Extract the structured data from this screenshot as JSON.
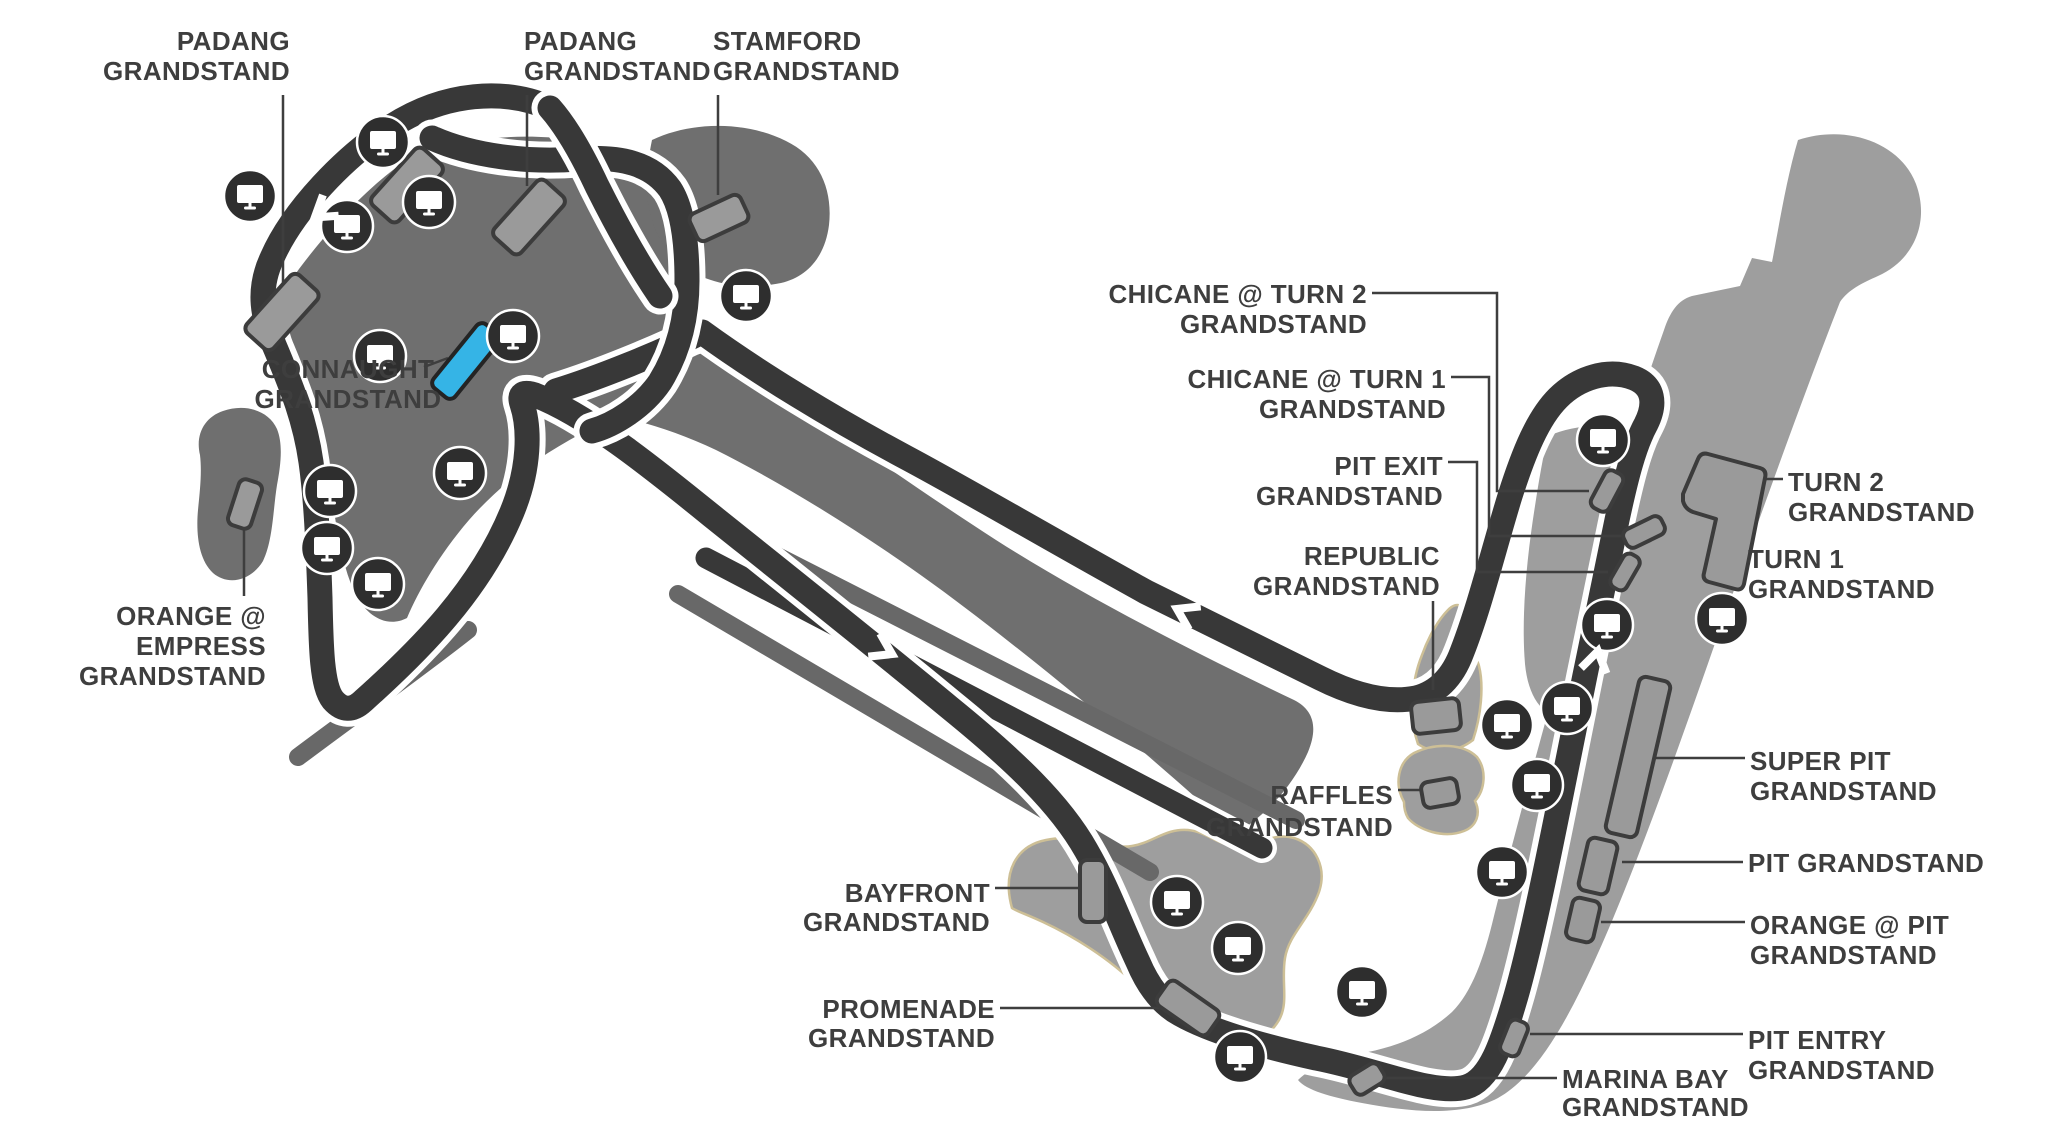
{
  "colors": {
    "track": "#383838",
    "label": "#3e3e3e",
    "leader": "#3e3e3e",
    "blob_dark": "#6f6f6f",
    "blob_light": "#9e9e9e",
    "strip": "#686868",
    "stand_fill": "#9a9a9a",
    "stand_stroke": "#3c3c3c",
    "highlight": "#35b4e6",
    "icon_bg": "#2e2e2e",
    "tan": "#cdbf96"
  },
  "labels": [
    {
      "id": "padang-1",
      "lines": [
        "PADANG",
        "GRANDSTAND"
      ],
      "x": 290,
      "y": 50,
      "dy": 30,
      "anchor": "end"
    },
    {
      "id": "padang-2",
      "lines": [
        "PADANG",
        "GRANDSTAND"
      ],
      "x": 524,
      "y": 50,
      "dy": 30,
      "anchor": "start"
    },
    {
      "id": "stamford",
      "lines": [
        "STAMFORD",
        "GRANDSTAND"
      ],
      "x": 713,
      "y": 50,
      "dy": 30,
      "anchor": "start"
    },
    {
      "id": "connaught",
      "lines": [
        "CONNAUGHT",
        "GRANDSTAND"
      ],
      "x": 348,
      "y": 378,
      "dy": 30,
      "anchor": "middle"
    },
    {
      "id": "orange-empress",
      "lines": [
        "ORANGE @",
        "EMPRESS",
        "GRANDSTAND"
      ],
      "x": 266,
      "y": 625,
      "dy": 30,
      "anchor": "end"
    },
    {
      "id": "chicane-turn-2",
      "lines": [
        "CHICANE @ TURN 2",
        "GRANDSTAND"
      ],
      "x": 1367,
      "y": 303,
      "dy": 30,
      "anchor": "end"
    },
    {
      "id": "chicane-turn-1",
      "lines": [
        "CHICANE @ TURN 1",
        "GRANDSTAND"
      ],
      "x": 1446,
      "y": 388,
      "dy": 30,
      "anchor": "end"
    },
    {
      "id": "pit-exit",
      "lines": [
        "PIT EXIT",
        "GRANDSTAND"
      ],
      "x": 1443,
      "y": 475,
      "dy": 30,
      "anchor": "end"
    },
    {
      "id": "republic",
      "lines": [
        "REPUBLIC",
        "GRANDSTAND"
      ],
      "x": 1440,
      "y": 565,
      "dy": 30,
      "anchor": "end"
    },
    {
      "id": "raffles",
      "lines": [
        "RAFFLES",
        "GRANDSTAND"
      ],
      "x": 1393,
      "y": 804,
      "dy": 32,
      "anchor": "end"
    },
    {
      "id": "turn-2",
      "lines": [
        "TURN 2",
        "GRANDSTAND"
      ],
      "x": 1788,
      "y": 491,
      "dy": 30,
      "anchor": "start"
    },
    {
      "id": "turn-1",
      "lines": [
        "TURN 1",
        "GRANDSTAND"
      ],
      "x": 1748,
      "y": 568,
      "dy": 30,
      "anchor": "start"
    },
    {
      "id": "super-pit",
      "lines": [
        "SUPER PIT",
        "GRANDSTAND"
      ],
      "x": 1750,
      "y": 770,
      "dy": 30,
      "anchor": "start"
    },
    {
      "id": "pit",
      "lines": [
        "PIT GRANDSTAND"
      ],
      "x": 1748,
      "y": 872,
      "dy": 30,
      "anchor": "start"
    },
    {
      "id": "orange-pit",
      "lines": [
        "ORANGE @ PIT",
        "GRANDSTAND"
      ],
      "x": 1750,
      "y": 934,
      "dy": 30,
      "anchor": "start"
    },
    {
      "id": "pit-entry",
      "lines": [
        "PIT ENTRY",
        "GRANDSTAND"
      ],
      "x": 1748,
      "y": 1049,
      "dy": 30,
      "anchor": "start"
    },
    {
      "id": "marina-bay",
      "lines": [
        "MARINA BAY",
        "GRANDSTAND"
      ],
      "x": 1562,
      "y": 1088,
      "dy": 28,
      "anchor": "start"
    },
    {
      "id": "bayfront",
      "lines": [
        "BAYFRONT",
        "GRANDSTAND"
      ],
      "x": 990,
      "y": 902,
      "dy": 29,
      "anchor": "end"
    },
    {
      "id": "promenade",
      "lines": [
        "PROMENADE",
        "GRANDSTAND"
      ],
      "x": 995,
      "y": 1018,
      "dy": 29,
      "anchor": "end"
    }
  ],
  "leaders": [
    {
      "id": "padang-1",
      "d": "M283,95 L283,290"
    },
    {
      "id": "padang-2",
      "d": "M527,95 L527,186"
    },
    {
      "id": "stamford",
      "d": "M718,95 L718,195"
    },
    {
      "id": "connaught",
      "d": "M424,367 L448,358"
    },
    {
      "id": "orange-empress",
      "d": "M244,528 L244,596"
    },
    {
      "id": "chicane-turn-2",
      "d": "M1372,293 L1497,293 L1497,491 L1589,491"
    },
    {
      "id": "chicane-turn-1",
      "d": "M1451,377 L1489,377 L1489,536 L1625,536"
    },
    {
      "id": "pit-exit",
      "d": "M1448,462 L1477,462 L1477,572 L1608,572"
    },
    {
      "id": "republic",
      "d": "M1433,601 L1433,690"
    },
    {
      "id": "raffles",
      "d": "M1398,790 L1423,790"
    },
    {
      "id": "turn-2",
      "d": "M1783,479 L1762,479"
    },
    {
      "id": "turn-1",
      "d": "M1743,556 L1732,556"
    },
    {
      "id": "super-pit",
      "d": "M1745,758 L1640,758"
    },
    {
      "id": "pit",
      "d": "M1743,862 L1622,862"
    },
    {
      "id": "orange-pit",
      "d": "M1745,922 L1601,922"
    },
    {
      "id": "pit-entry",
      "d": "M1743,1034 L1530,1034"
    },
    {
      "id": "marina-bay",
      "d": "M1557,1078 L1386,1078"
    },
    {
      "id": "bayfront",
      "d": "M995,888 L1079,888"
    },
    {
      "id": "promenade",
      "d": "M1000,1008 L1164,1008"
    }
  ],
  "stands": [
    {
      "id": "padang-a",
      "cx": 282,
      "cy": 312,
      "w": 78,
      "h": 36,
      "r": -48
    },
    {
      "id": "padang-b",
      "cx": 407,
      "cy": 185,
      "w": 76,
      "h": 36,
      "r": -48
    },
    {
      "id": "padang-c",
      "cx": 529,
      "cy": 217,
      "w": 76,
      "h": 36,
      "r": -48
    },
    {
      "id": "stamford",
      "cx": 719,
      "cy": 218,
      "w": 56,
      "h": 30,
      "r": -25
    },
    {
      "id": "connaught",
      "cx": 466,
      "cy": 361,
      "w": 82,
      "h": 28,
      "r": -51,
      "highlight": true
    },
    {
      "id": "orange-empress",
      "cx": 245,
      "cy": 504,
      "w": 48,
      "h": 24,
      "r": -72
    },
    {
      "id": "chicane-turn-2",
      "cx": 1607,
      "cy": 491,
      "w": 42,
      "h": 20,
      "r": -62
    },
    {
      "id": "chicane-turn-1",
      "cx": 1644,
      "cy": 532,
      "w": 42,
      "h": 20,
      "r": -26
    },
    {
      "id": "pit-exit",
      "cx": 1625,
      "cy": 572,
      "w": 38,
      "h": 18,
      "r": -60
    },
    {
      "id": "super-pit",
      "cx": 1638,
      "cy": 757,
      "w": 160,
      "h": 32,
      "r": -77
    },
    {
      "id": "pit",
      "cx": 1598,
      "cy": 866,
      "w": 54,
      "h": 30,
      "r": -77
    },
    {
      "id": "orange-pit",
      "cx": 1583,
      "cy": 920,
      "w": 42,
      "h": 28,
      "r": -77
    },
    {
      "id": "pit-entry",
      "cx": 1514,
      "cy": 1038,
      "w": 36,
      "h": 20,
      "r": -68
    },
    {
      "id": "marina-bay",
      "cx": 1367,
      "cy": 1079,
      "w": 34,
      "h": 22,
      "r": -32
    },
    {
      "id": "bayfront",
      "cx": 1093,
      "cy": 891,
      "w": 26,
      "h": 62,
      "r": 0
    },
    {
      "id": "promenade",
      "cx": 1188,
      "cy": 1008,
      "w": 62,
      "h": 30,
      "r": 35
    },
    {
      "id": "raffles",
      "cx": 1440,
      "cy": 793,
      "w": 36,
      "h": 26,
      "r": -10
    },
    {
      "id": "republic",
      "cx": 1436,
      "cy": 716,
      "w": 48,
      "h": 32,
      "r": -6
    }
  ],
  "turn_grandstand_shape": "M1683,494 L1698,459 Q1701,452 1708,454 L1760,468 Q1767,470 1765,478 L1744,584 Q1742,591 1735,589 L1709,582 Q1702,580 1704,573 L1716,519 L1693,512 Q1685,509 1683,501 Z",
  "tv_icons": [
    [
      383,
      142
    ],
    [
      250,
      196
    ],
    [
      347,
      226
    ],
    [
      429,
      202
    ],
    [
      513,
      336
    ],
    [
      380,
      356
    ],
    [
      460,
      473
    ],
    [
      330,
      491
    ],
    [
      327,
      548
    ],
    [
      378,
      584
    ],
    [
      746,
      296
    ],
    [
      1603,
      440
    ],
    [
      1607,
      625
    ],
    [
      1722,
      619
    ],
    [
      1507,
      725
    ],
    [
      1567,
      708
    ],
    [
      1537,
      785
    ],
    [
      1502,
      872
    ],
    [
      1177,
      902
    ],
    [
      1238,
      948
    ],
    [
      1362,
      992
    ],
    [
      1240,
      1057
    ]
  ],
  "arrows": [
    {
      "x": 322,
      "y": 212,
      "r": 233
    },
    {
      "x": 884,
      "y": 650,
      "r": 117
    },
    {
      "x": 1185,
      "y": 613,
      "r": -63
    },
    {
      "x": 1596,
      "y": 660,
      "r": 12
    }
  ]
}
